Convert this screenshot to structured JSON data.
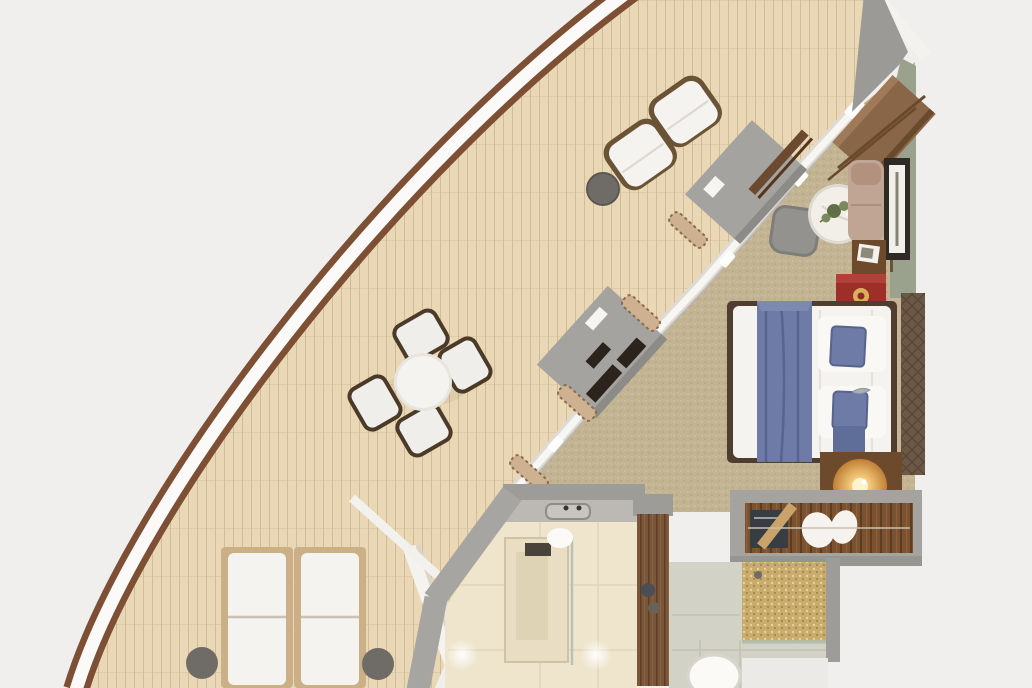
{
  "canvas": {
    "width": 1032,
    "height": 688
  },
  "scene_type": "top-down 3D floor plan render of a ship suite with wrap-around balcony",
  "colors": {
    "background": "#f0efed",
    "hull-rail-brown": "#7d4f35",
    "hull-band-white": "#fbfaf8",
    "deck-plank": "#ead7b5",
    "deck-plank-seam": "#d2bc95",
    "carpet": "#c2b392",
    "carpet-speckle": "#d2c4a4",
    "carpet-speckle-dark": "#b0a181",
    "wall-gray": "#a2a09c",
    "wall-sage": "#9aa18c",
    "panel-gray": "#a4a3a0",
    "console-dark": "#2c241c",
    "curtain-beige": "#cdb190",
    "curtain-brown": "#8a6b4a",
    "white-soft": "#f5f3ef",
    "frame-dark-wood": "#5a4631",
    "side-table-gray": "#6f6c68",
    "lounger-base-tan": "#cbb087",
    "bed-blue": "#6d7ba6",
    "bed-blue-dark": "#57648c",
    "red-cabinet": "#9e2f28",
    "lamp-glow": "#f3c979",
    "marble-white": "#f2efe9",
    "plant-green": "#5f7048",
    "chaise-blush": "#c0a494",
    "desk-wood": "#8a6648",
    "walnut-dark": "#6e4a2c",
    "headboard-beige": "#c9b49a",
    "panel-bronze": "#6b5846",
    "bath-floor": "#efe5cd",
    "bath-counter": "#bcb9b4",
    "door-wood": "#7b5638",
    "mosaic-gold": "#c9ab6e",
    "corridor-tile": "#d3d2c6",
    "toilet-white": "#fbfaf7",
    "safe-dark": "#383d43",
    "wardrobe-wood": "#7a5230"
  },
  "inventory": [
    "balcony-deck",
    "hull-railing",
    "lounge-armchair",
    "lounge-armchair",
    "deck-side-table",
    "dining-table",
    "dining-chair",
    "dining-chair",
    "dining-chair",
    "dining-chair",
    "sun-lounger",
    "sun-lounger",
    "lounger-side-table",
    "lounger-side-table",
    "privacy-divider",
    "windbreak-panel",
    "window-wall",
    "curtain",
    "console-unit",
    "writing-desk",
    "marble-table",
    "plant",
    "armchair",
    "chaise",
    "wall-art",
    "photo-table",
    "minibar-cabinet",
    "double-bed",
    "bed-runner",
    "pillow",
    "pillow",
    "nightstand",
    "table-lamp",
    "headboard",
    "wardrobe",
    "safe",
    "bathroom",
    "vanity",
    "shower",
    "bathroom-door",
    "corridor",
    "mosaic-shower",
    "toilet"
  ]
}
